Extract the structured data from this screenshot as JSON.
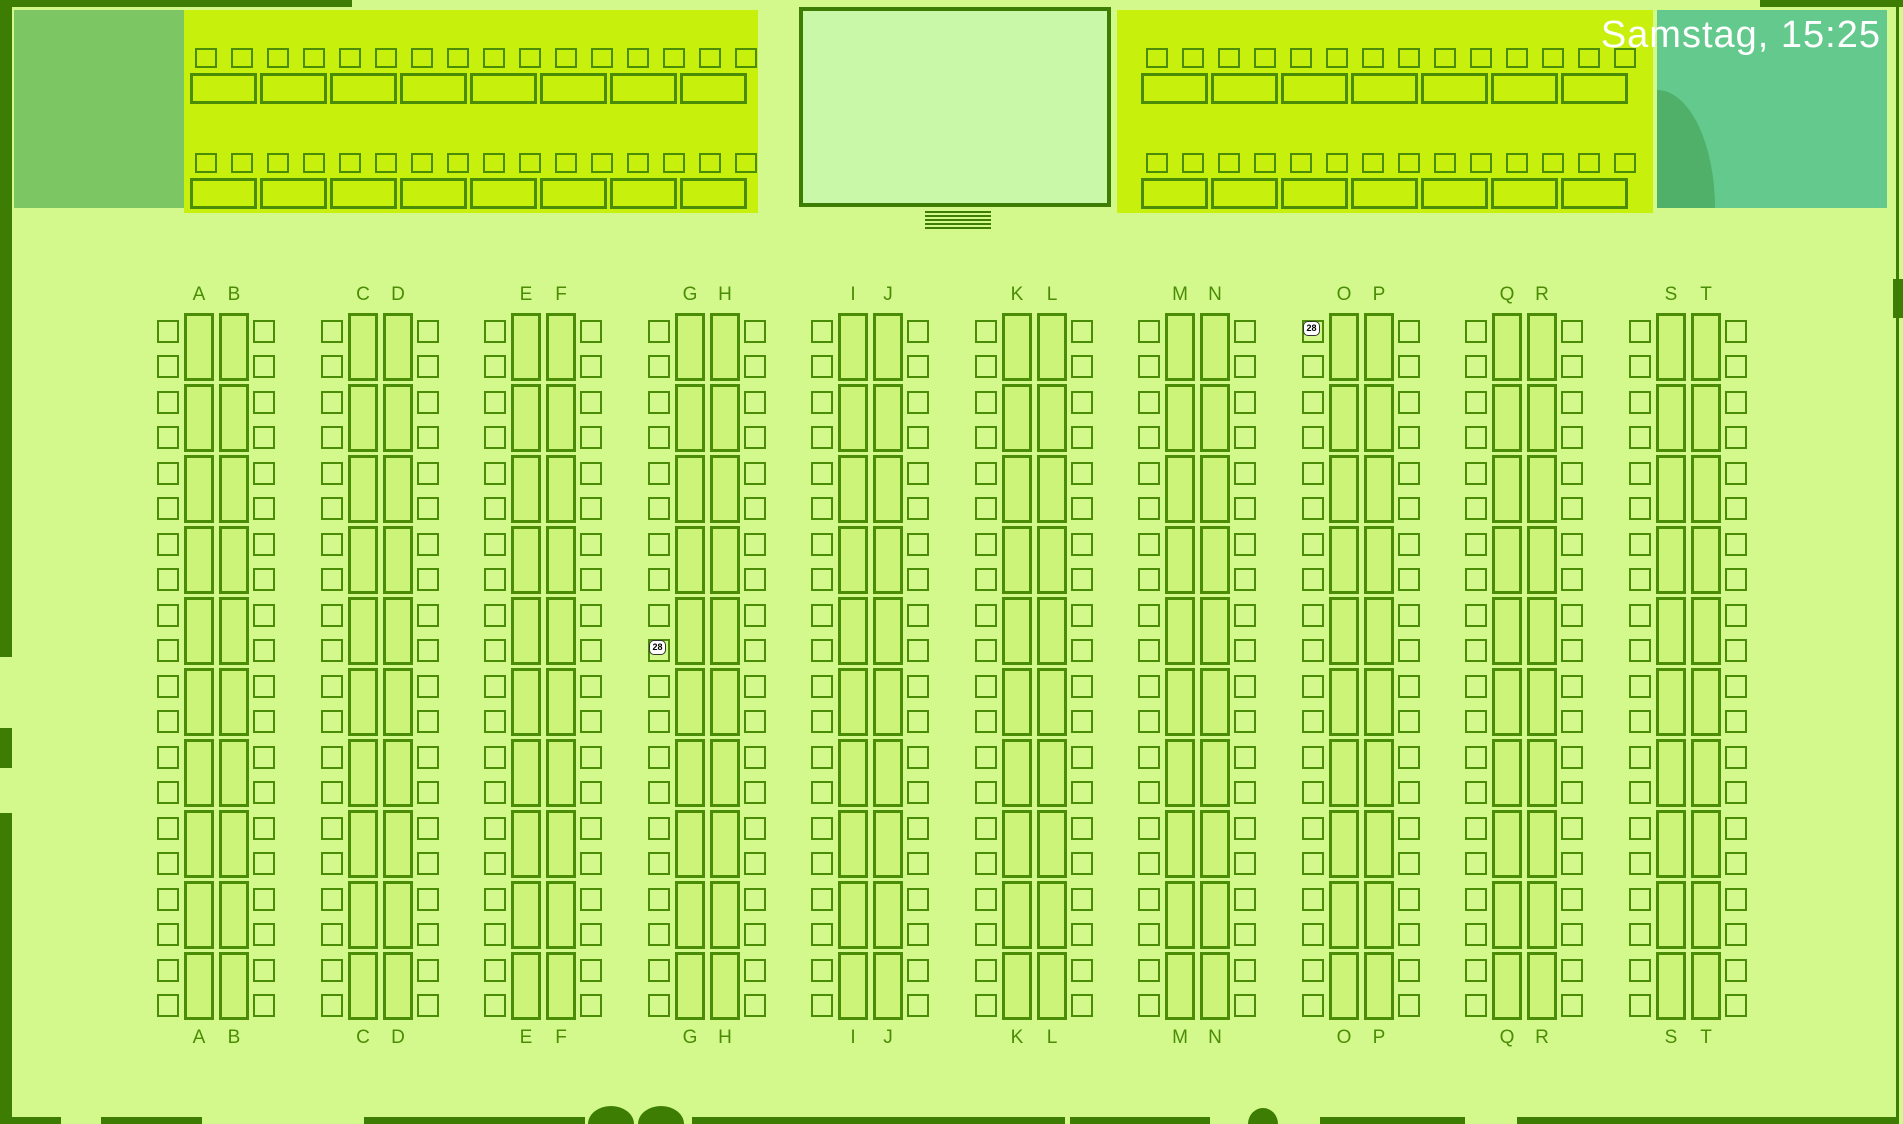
{
  "screen": {
    "datetime": "Samstag, 15:25"
  },
  "seat_map": {
    "column_pairs": [
      {
        "left": "A",
        "right": "B"
      },
      {
        "left": "C",
        "right": "D"
      },
      {
        "left": "E",
        "right": "F"
      },
      {
        "left": "G",
        "right": "H"
      },
      {
        "left": "I",
        "right": "J"
      },
      {
        "left": "K",
        "right": "L"
      },
      {
        "left": "M",
        "right": "N"
      },
      {
        "left": "O",
        "right": "P"
      },
      {
        "left": "Q",
        "right": "R"
      },
      {
        "left": "S",
        "right": "T"
      }
    ],
    "desks_per_letter_column": 10,
    "chairs_per_desk": 2,
    "top_left_section": {
      "rows": 2,
      "chairs_per_row": 16,
      "desks_per_row": 8
    },
    "top_right_section": {
      "rows": 2,
      "chairs_per_row": 14,
      "desks_per_row": 7
    },
    "markers": [
      {
        "label": "28",
        "area": "column O, first left seat",
        "x": 1303,
        "y": 321
      },
      {
        "label": "28",
        "area": "column G, tenth left seat",
        "x": 649,
        "y": 640
      }
    ]
  },
  "colors": {
    "background": "#d3f98c",
    "section_bright": "#c8f00d",
    "outline": "#4a8c05",
    "frame": "#3e7d04",
    "desk_fill": "#ccf478",
    "chair_fill": "#d3f98c",
    "box_fill": "#c9f8a8",
    "staff_block": "#7cc763",
    "clock_panel": "#63c98c",
    "clock_panel_shade": "#50b06a",
    "datetime_text": "#ffffff",
    "marker_bg": "#ffffff",
    "marker_border": "#333333",
    "marker_text": "#000000"
  }
}
